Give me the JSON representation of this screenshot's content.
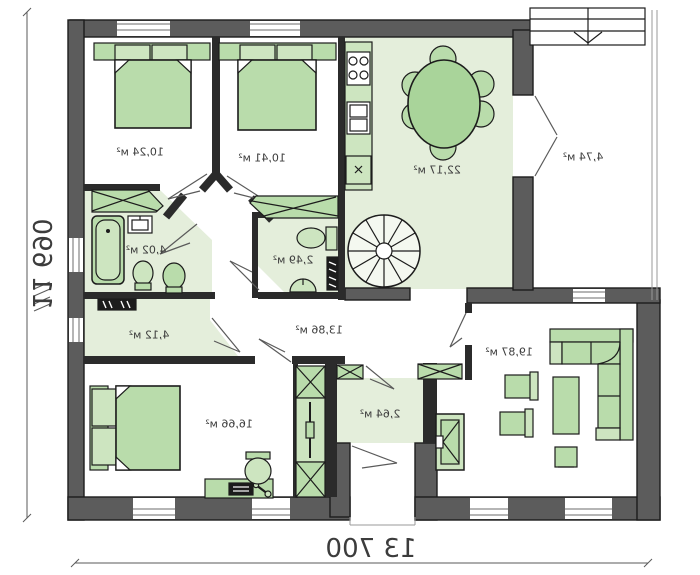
{
  "plan_type": "mirrored-floor-plan",
  "rooms": {
    "bedroom_top_left": "10,24 м²",
    "bedroom_top_mid": "10,41 м²",
    "kitchen_dining": "22,17 м²",
    "porch_entry": "4,74 м²",
    "bathroom": "4,02 м²",
    "wc": "2,49 м²",
    "hallway": "13,86 м²",
    "storage": "4,12 м²",
    "bedroom_bottom": "16,66 м²",
    "vestibule": "2,64 м²",
    "living_room": "19,87 м²"
  },
  "dimensions": {
    "overall_width": "13 700",
    "overall_height": "11 690"
  },
  "colors": {
    "exterior_wall": "#5c5c5c",
    "partition_wall": "#2b2b2b",
    "floor_green": "#e4eedb",
    "furniture_green": "#b9dcab",
    "furniture_light": "#cde5c0",
    "outline": "#1c1c1c",
    "text": "#3d3d3d"
  }
}
